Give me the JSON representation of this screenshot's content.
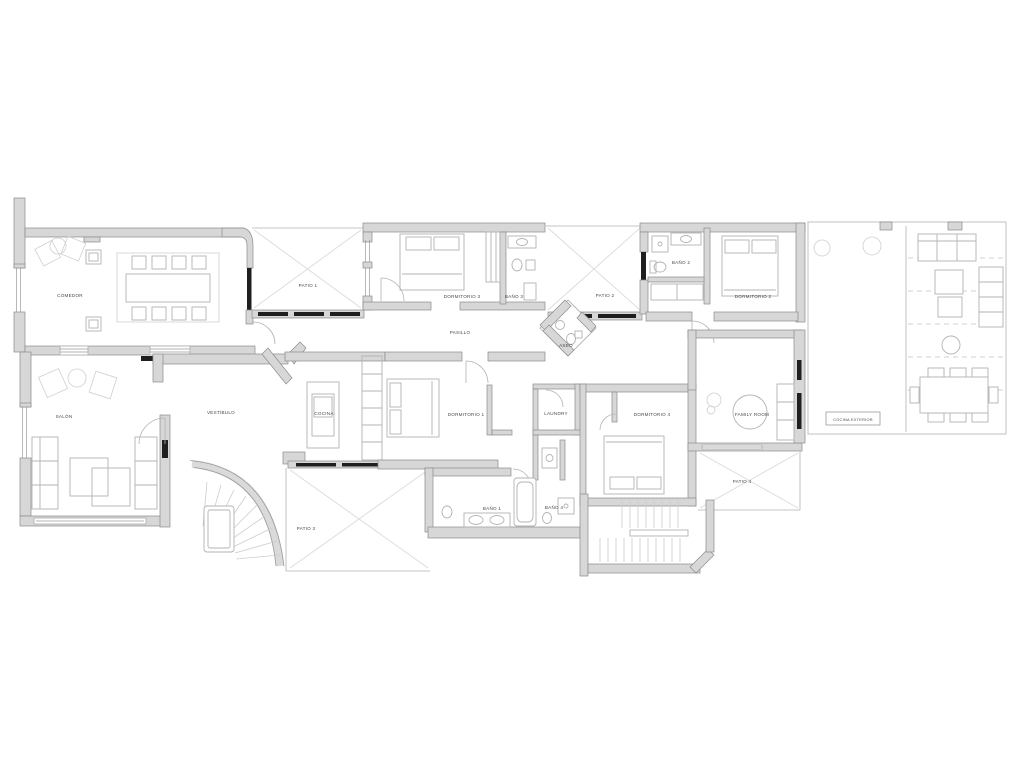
{
  "document": {
    "type": "architectural floor plan",
    "language": "Spanish"
  },
  "rooms": {
    "comedor": "COMEDOR",
    "salon": "SALÓN",
    "vestibulo": "VESTÍBULO",
    "cocina": "COCINA",
    "pasillo": "PASILLO",
    "aseo": "ASEO",
    "laundry": "LAUNDRY",
    "family_room": "FAMILY ROOM",
    "dormitorio1": "DORMITORIO 1",
    "dormitorio2": "DORMITORIO 2",
    "dormitorio3": "DORMITORIO 3",
    "dormitorio4": "DORMITORIO 4",
    "bano1": "BAÑO 1",
    "bano2": "BAÑO 2",
    "bano3": "BAÑO 3",
    "bano4": "BAÑO 4",
    "patio1": "PATIO 1",
    "patio2": "PATIO 2",
    "patio3": "PATIO 3",
    "patio4": "PATIO 4",
    "cocina_exterior": "COCINA EXTERIOR"
  },
  "colors": {
    "background": "#ffffff",
    "wall_fill": "#d7d7d7",
    "wall_stroke": "#8c8c8c",
    "furniture": "#b3b3b3",
    "glazing": "#1f1f1f",
    "patio_line": "#dadada",
    "label": "#4a4a4a",
    "thin_line": "#c6c6c6"
  }
}
